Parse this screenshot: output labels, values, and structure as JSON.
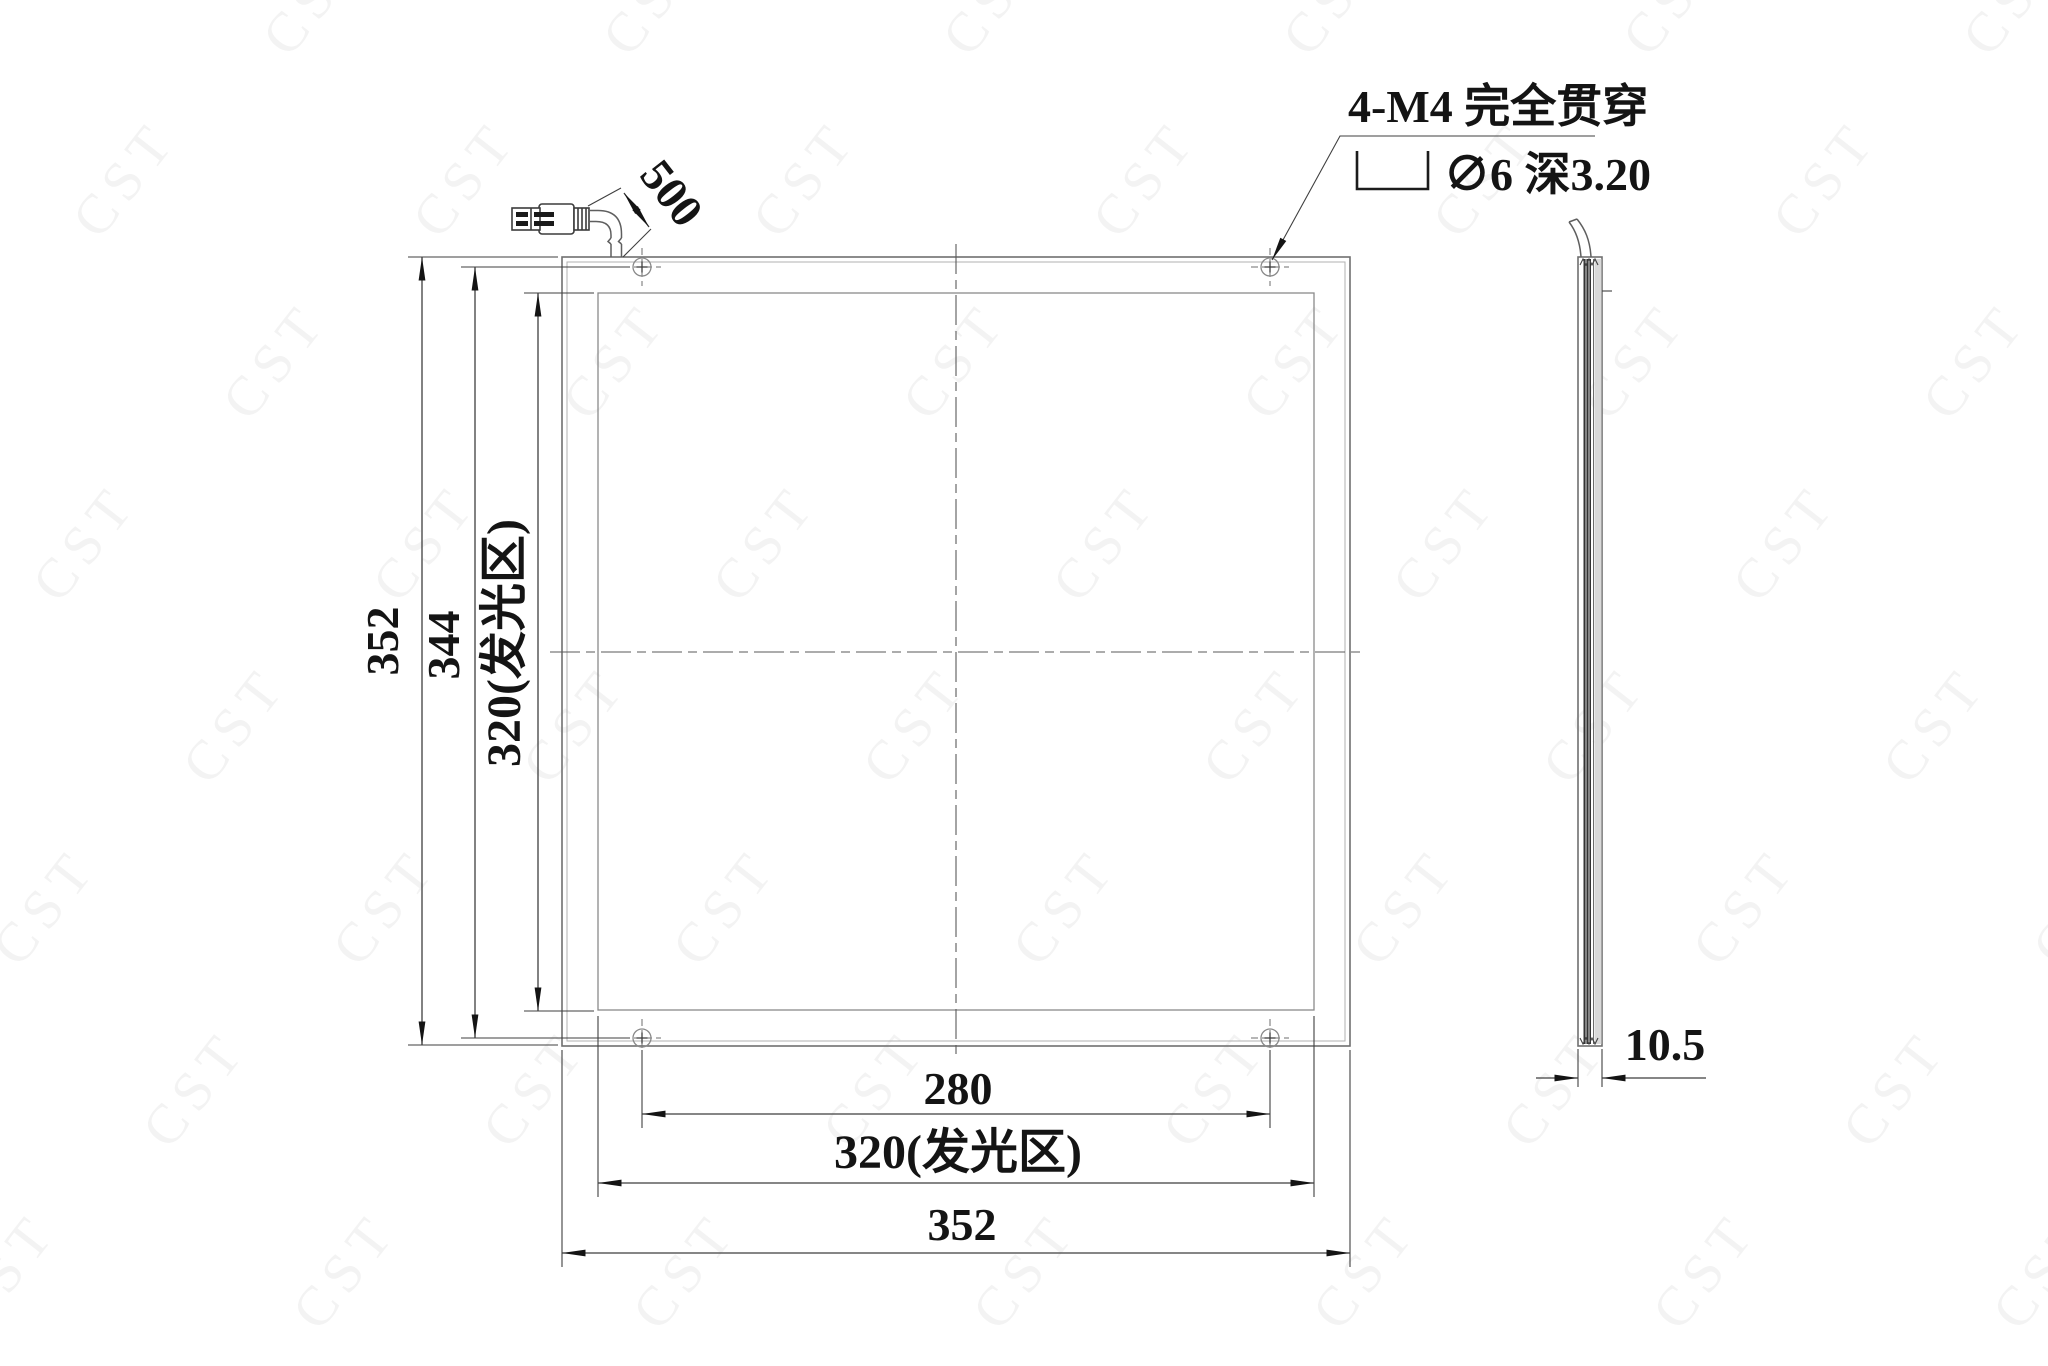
{
  "watermark": {
    "text": "CST"
  },
  "colors": {
    "line": "#707070",
    "dim": "#3f3f3f",
    "text": "#141414",
    "wm": "#f3f3f3",
    "dark": "#333333",
    "gray": "#d9d9d9"
  },
  "dimensions": {
    "front": {
      "outer_height": "352",
      "hole_spacing_vertical": "344",
      "luminous_height": "320(发光区)",
      "hole_spacing_horizontal": "280",
      "luminous_width": "320(发光区)",
      "outer_width": "352",
      "cable_length": "500"
    },
    "side": {
      "thickness": "10.5"
    }
  },
  "annotations": {
    "mounting_note": "4-M4 完全贯穿",
    "counterbore_spec": "∅6 深3.20"
  }
}
